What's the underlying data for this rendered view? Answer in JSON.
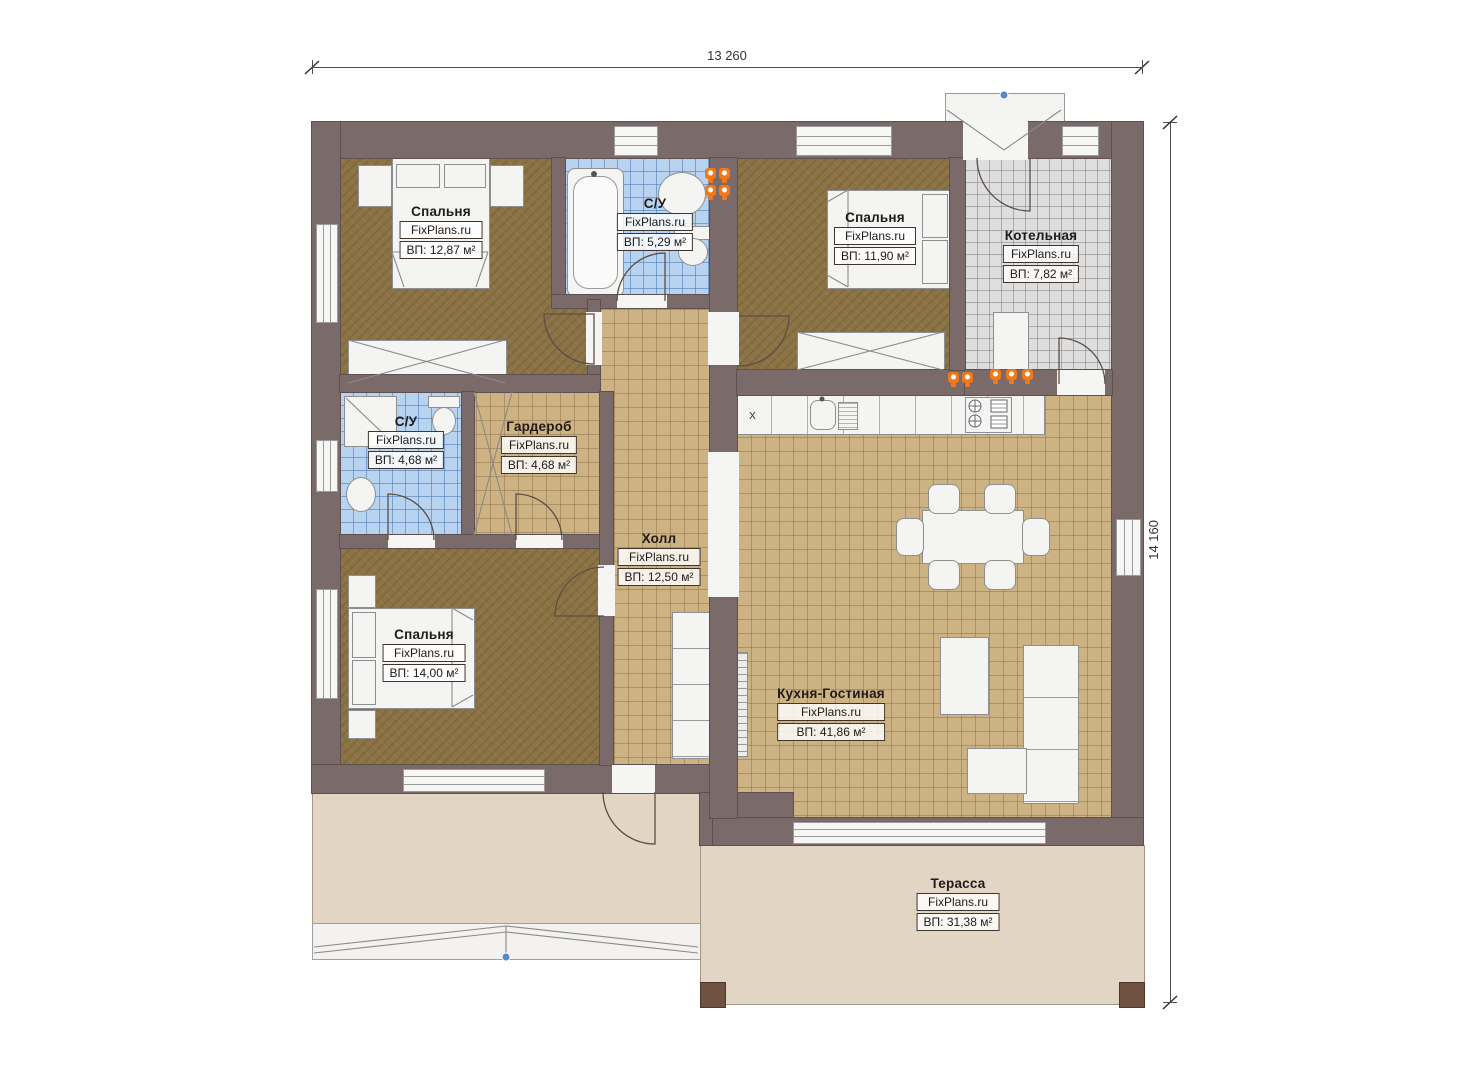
{
  "plan": {
    "brand": "FixPlans.ru",
    "dimensions": {
      "width_label": "13 260",
      "height_label": "14 160"
    },
    "kitchen_unit_marker": "x",
    "rooms": [
      {
        "id": "bedroom-top-left",
        "name": "Спальня",
        "area": "ВП: 12,87 м²"
      },
      {
        "id": "bathroom-top",
        "name": "С/У",
        "area": "ВП: 5,29 м²"
      },
      {
        "id": "bedroom-top-right",
        "name": "Спальня",
        "area": "ВП: 11,90 м²"
      },
      {
        "id": "boiler-room",
        "name": "Котельная",
        "area": "ВП: 7,82 м²"
      },
      {
        "id": "bathroom-left",
        "name": "С/У",
        "area": "ВП: 4,68 м²"
      },
      {
        "id": "wardrobe-room",
        "name": "Гардероб",
        "area": "ВП: 4,68 м²"
      },
      {
        "id": "hall",
        "name": "Холл",
        "area": "ВП: 12,50 м²"
      },
      {
        "id": "bedroom-bottom-left",
        "name": "Спальня",
        "area": "ВП: 14,00 м²"
      },
      {
        "id": "kitchen-living",
        "name": "Кухня-Гостиная",
        "area": "ВП: 41,86 м²"
      },
      {
        "id": "terrace",
        "name": "Терасса",
        "area": "ВП: 31,38 м²"
      }
    ],
    "colors": {
      "wall": "#7b6a6a",
      "bedroom_floor": "#8c7345",
      "tile_floor": "#cdb284",
      "bathroom_tile": "#b7d3ef",
      "boiler_tile": "#dedede",
      "terrace": "#e2d5c3",
      "accent_orange": "#f07818",
      "marker_blue": "#5b86c8"
    }
  }
}
